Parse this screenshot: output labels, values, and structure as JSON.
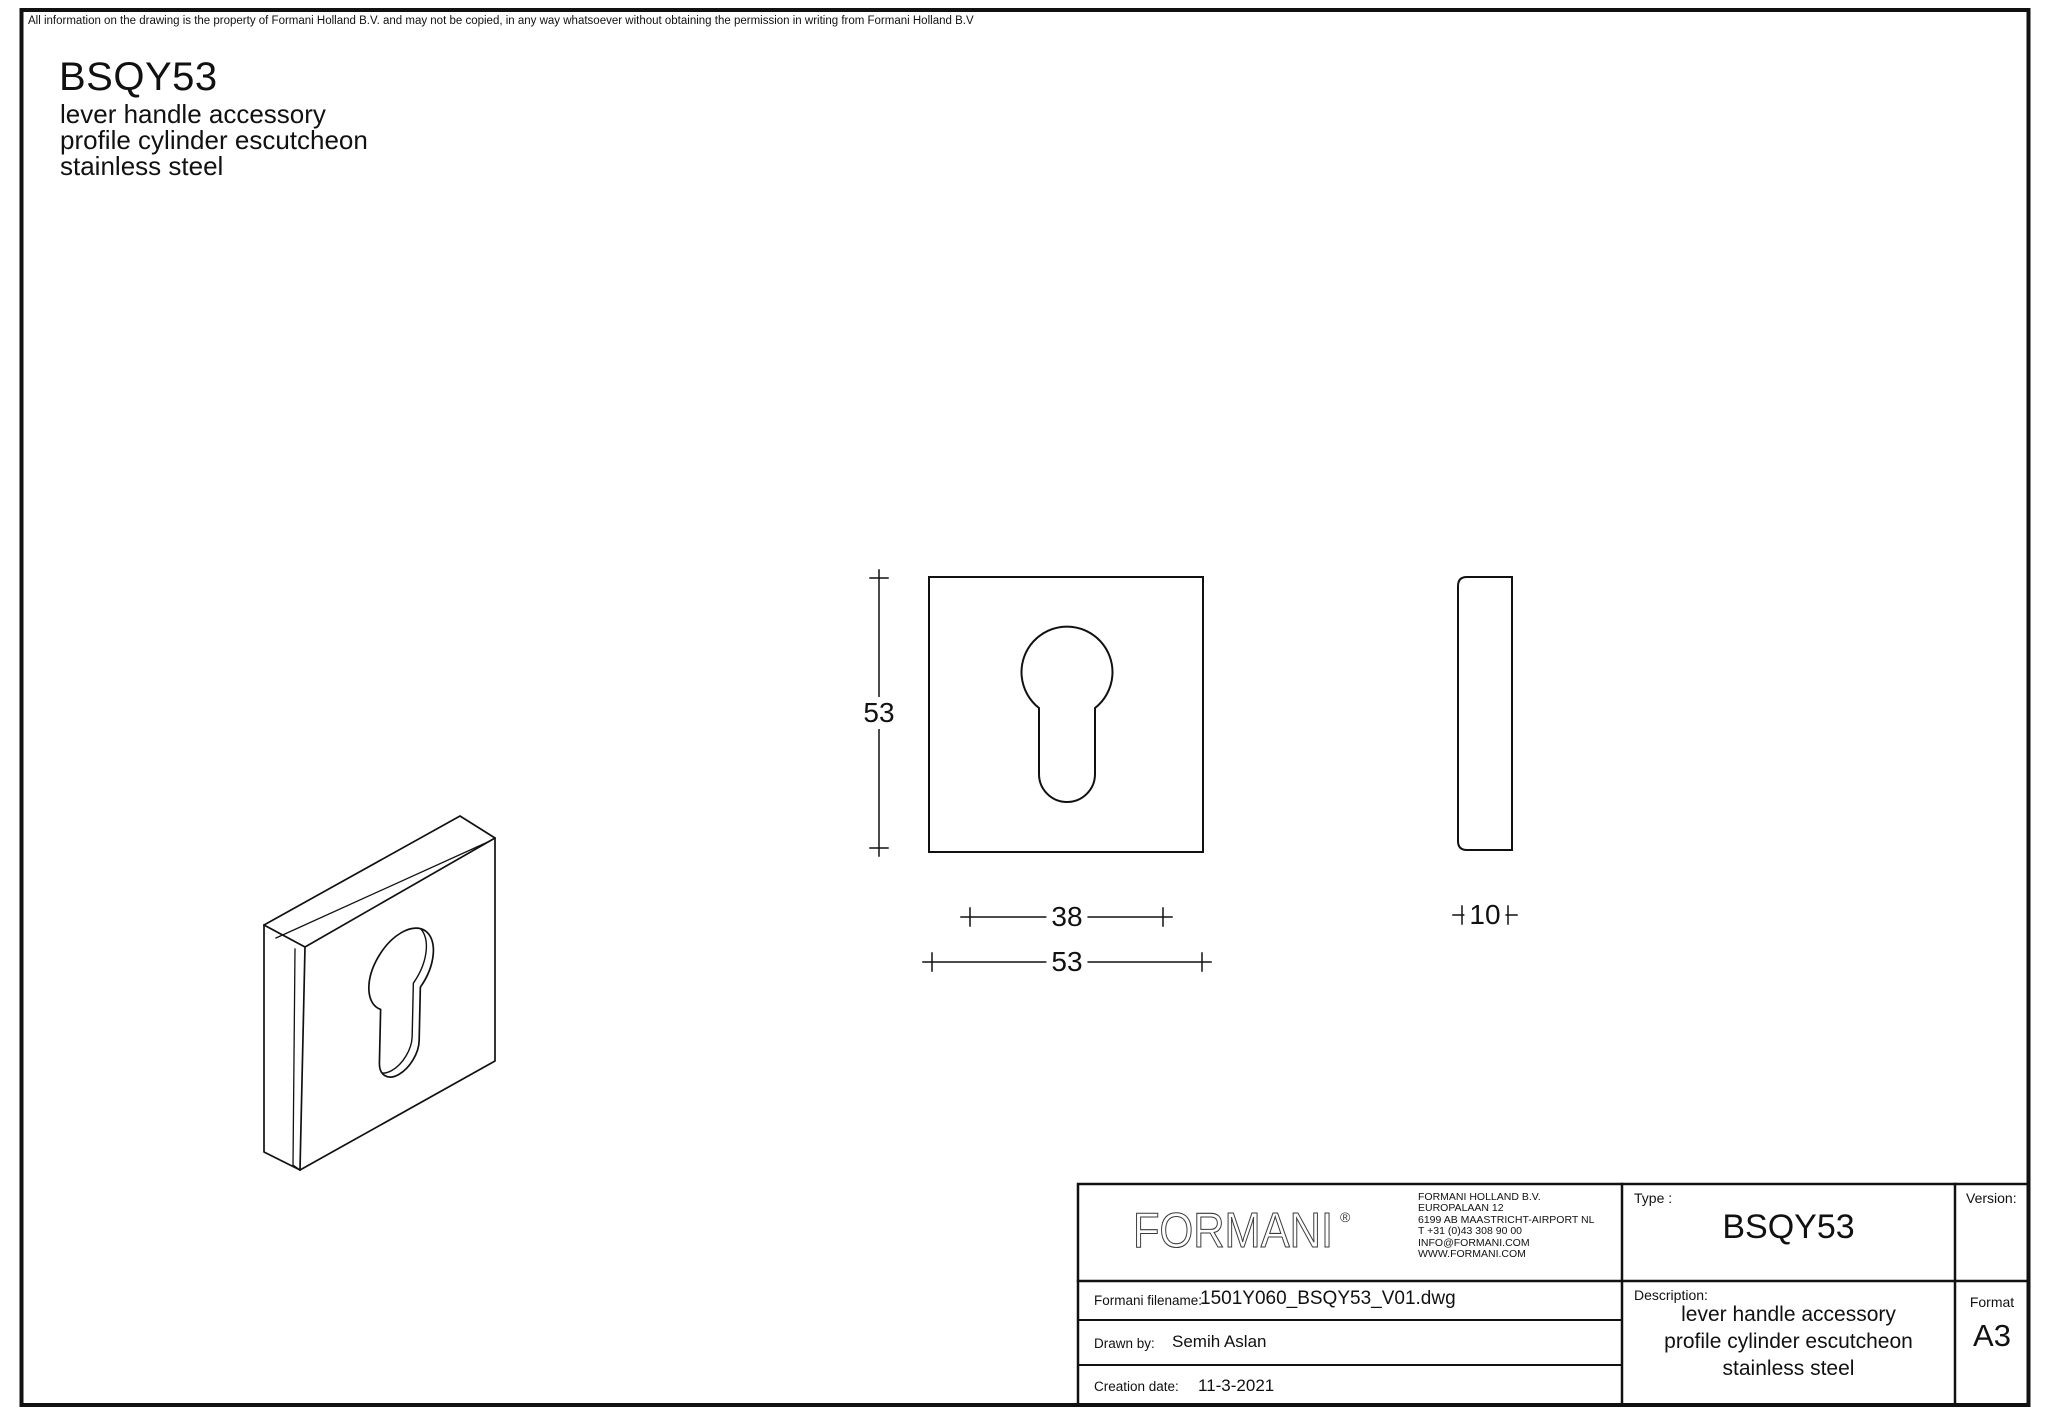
{
  "sheet": {
    "disclaimer": "All information on the drawing is the property of Formani Holland B.V. and may not be copied, in any way whatsoever without obtaining the permission in writing from Formani Holland B.V",
    "product_code": "BSQY53",
    "product_lines": [
      "lever handle accessory",
      "profile cylinder escutcheon",
      "stainless steel"
    ]
  },
  "dimensions": {
    "front_height": "53",
    "hole_width": "38",
    "front_width": "53",
    "thickness": "10"
  },
  "title_block": {
    "logo_text": "FORMANI",
    "logo_mark": "®",
    "company_lines": [
      "FORMANI HOLLAND B.V.",
      "EUROPALAAN 12",
      "6199 AB MAASTRICHT-AIRPORT NL",
      "T +31 (0)43 308 90 00",
      "INFO@FORMANI.COM",
      "WWW.FORMANI.COM"
    ],
    "type_label": "Type :",
    "type_value": "BSQY53",
    "version_label": "Version:",
    "version_value": "",
    "filename_label": "Formani filename:",
    "filename_value": "1501Y060_BSQY53_V01.dwg",
    "drawn_by_label": "Drawn by:",
    "drawn_by_value": "Semih Aslan",
    "creation_date_label": "Creation date:",
    "creation_date_value": "11-3-2021",
    "description_label": "Description:",
    "description_lines": [
      "lever handle accessory",
      "profile cylinder escutcheon",
      "stainless steel"
    ],
    "format_label": "Format",
    "format_value": "A3"
  },
  "colors": {
    "line": "#111111",
    "background": "#ffffff",
    "logo": "#3a3a3a"
  }
}
